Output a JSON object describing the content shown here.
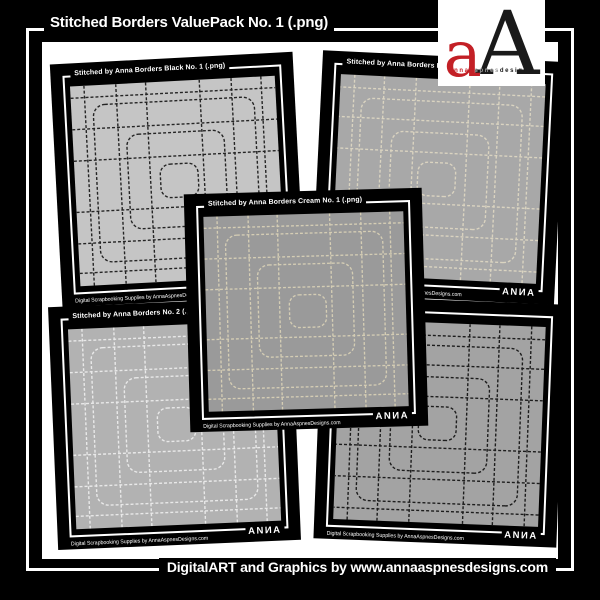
{
  "page": {
    "background": "#000000",
    "panel_color": "#ffffff"
  },
  "header": {
    "title": "Stitched Borders ValuePack No. 1 (.png)"
  },
  "footer": {
    "credit": "DigitalART and Graphics by www.annaaspnesdesigns.com"
  },
  "logo": {
    "mark_lower": "a",
    "mark_upper": "A",
    "tagline": {
      "part1": "anna",
      "part2": "aspnes",
      "part3": "designs"
    },
    "accent_red": "#c32026",
    "mark_black": "#1a1a1a",
    "tagline_gray": "#9a9a9a"
  },
  "cards": [
    {
      "title": "Stitched by Anna Borders Black No. 1 (.png)",
      "credit": "Digital Scrapbooking Supplies by AnnaAspnesDesigns.com",
      "watermark": "ANИA",
      "colors": {
        "bg": "#c5c5c5",
        "stitch": "#1c1c1c"
      }
    },
    {
      "title": "Stitched by Anna Borders No. 3 (.png)",
      "credit": "Digital Scrapbooking Supplies by AnnaAspnesDesigns.com",
      "watermark": "ANИA",
      "colors": {
        "bg": "#a8a8a8",
        "stitch": "#ddd6c2"
      }
    },
    {
      "title": "Stitched by Anna Borders Cream No. 1 (.png)",
      "credit": "Digital Scrapbooking Supplies by AnnaAspnesDesigns.com",
      "watermark": "ANИA",
      "colors": {
        "bg": "#9a9a9a",
        "stitch": "#d8d0b6"
      }
    },
    {
      "title": "Stitched by Anna Borders No. 2 (.png)",
      "credit": "Digital Scrapbooking Supplies by AnnaAspnesDesigns.com",
      "watermark": "ANИA",
      "colors": {
        "bg": "#b2b2b2",
        "stitch": "#ececec"
      }
    },
    {
      "title": "2 (.png)",
      "credit": "Digital Scrapbooking Supplies by AnnaAspnesDesigns.com",
      "watermark": "ANИA",
      "colors": {
        "bg": "#a3a3a3",
        "stitch": "#161616"
      }
    }
  ]
}
